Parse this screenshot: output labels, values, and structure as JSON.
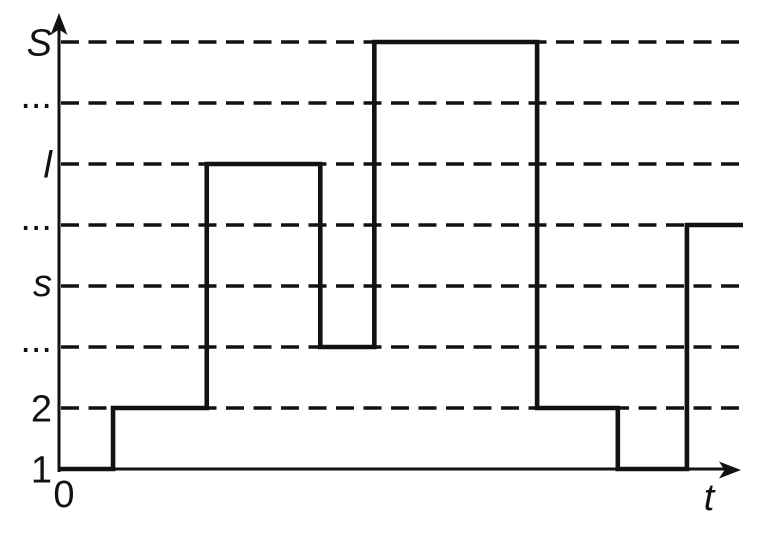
{
  "figure": {
    "background": "#ffffff",
    "ink": "#121212",
    "description": "Step diagram of a quantity changing over time t across discrete levels 1, 2, ..., s, ..., l, ..., S"
  },
  "chart_data": {
    "type": "line",
    "subtype": "step-function",
    "title": "",
    "xlabel": "t",
    "ylabel": "",
    "origin_label": "0",
    "x_axis": {
      "origin_tick_label": "0",
      "end_label": "t",
      "arrow": true,
      "numeric_ticks": false,
      "range_normalized": [
        0,
        1
      ]
    },
    "y_axis": {
      "arrow": true,
      "levels_bottom_to_top": [
        "1",
        "2",
        "...",
        "s",
        "...",
        "l",
        "...",
        "S"
      ],
      "italic_labels": [
        "S",
        "l",
        "s"
      ]
    },
    "grid": {
      "style": "dashed",
      "orientation": "horizontal",
      "on_levels": [
        "2",
        "...",
        "s",
        "...",
        "l",
        "...",
        "S"
      ],
      "note_level_1_is_x_axis": true
    },
    "series": [
      {
        "name": "level-vs-time",
        "steps": [
          {
            "from_t": 0,
            "to_t": 0.079,
            "level_index": 1,
            "level_label": "1"
          },
          {
            "from_t": 0.079,
            "to_t": 0.216,
            "level_index": 2,
            "level_label": "2"
          },
          {
            "from_t": 0.216,
            "to_t": 0.382,
            "level_index": 6,
            "level_label": "l"
          },
          {
            "from_t": 0.382,
            "to_t": 0.461,
            "level_index": 3,
            "level_label": "..."
          },
          {
            "from_t": 0.461,
            "to_t": 0.699,
            "level_index": 8,
            "level_label": "S"
          },
          {
            "from_t": 0.699,
            "to_t": 0.817,
            "level_index": 2,
            "level_label": "2"
          },
          {
            "from_t": 0.817,
            "to_t": 0.918,
            "level_index": 1,
            "level_label": "1"
          },
          {
            "from_t": 0.918,
            "to_t": 1.0,
            "level_index": 5,
            "level_label": "..."
          }
        ]
      }
    ]
  }
}
